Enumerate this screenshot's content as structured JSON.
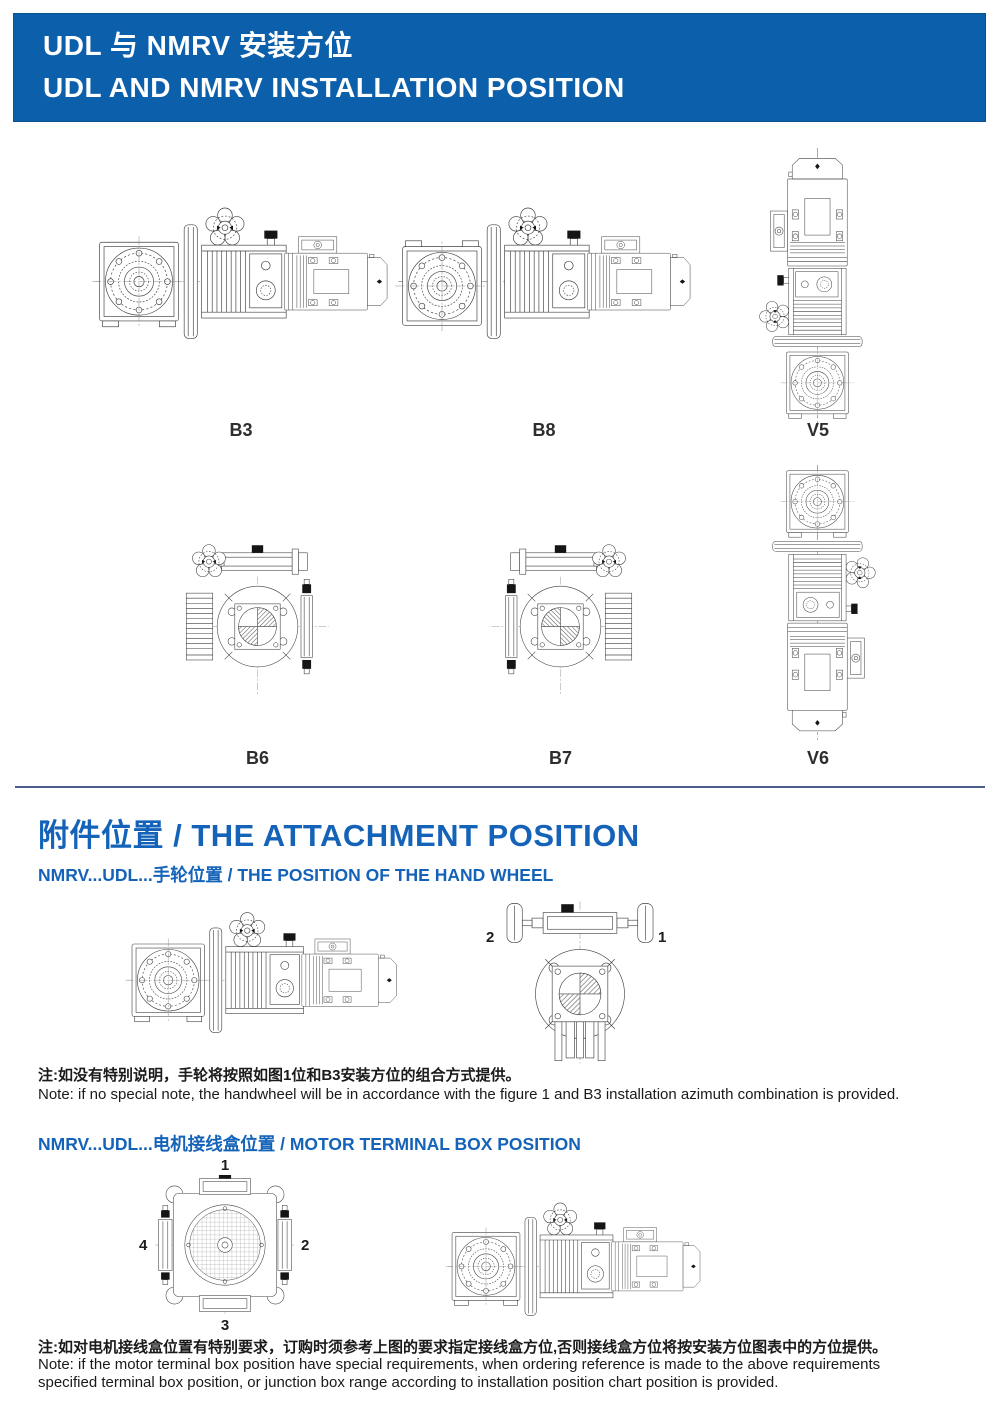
{
  "header": {
    "title_zh": "UDL 与 NMRV 安装方位",
    "title_en": "UDL AND NMRV INSTALLATION POSITION"
  },
  "installation": {
    "positions": [
      {
        "label": "B3"
      },
      {
        "label": "B8"
      },
      {
        "label": "V5"
      },
      {
        "label": "B6"
      },
      {
        "label": "B7"
      },
      {
        "label": "V6"
      }
    ]
  },
  "attachment": {
    "title": "附件位置 / THE ATTACHMENT POSITION",
    "handwheel": {
      "subtitle": "NMRV...UDL...手轮位置 / THE POSITION OF THE HAND WHEEL",
      "wheel_labels": {
        "left": "2",
        "right": "1"
      },
      "note_zh": "注:如没有特别说明，手轮将按照如图1位和B3安装方位的组合方式提供。",
      "note_en": "Note: if no special note, the handwheel will be in accordance with the figure 1 and B3 installation azimuth combination is provided."
    },
    "terminal_box": {
      "subtitle": "NMRV...UDL...电机接线盒位置 / MOTOR TERMINAL BOX POSITION",
      "position_labels": [
        "1",
        "2",
        "3",
        "4"
      ],
      "note_zh": "注:如对电机接线盒位置有特别要求，订购时须参考上图的要求指定接线盒方位,否则接线盒方位将按安装方位图表中的方位提供。",
      "note_en_line1": "Note: if the motor terminal box position have special requirements, when ordering reference is made to the above requirements",
      "note_en_line2": "specified terminal box position, or junction box range according to installation position chart position is provided."
    }
  },
  "colors": {
    "banner_blue": "#0c5fab",
    "heading_blue": "#1563b8",
    "divider_navy": "#4a5d8c"
  }
}
